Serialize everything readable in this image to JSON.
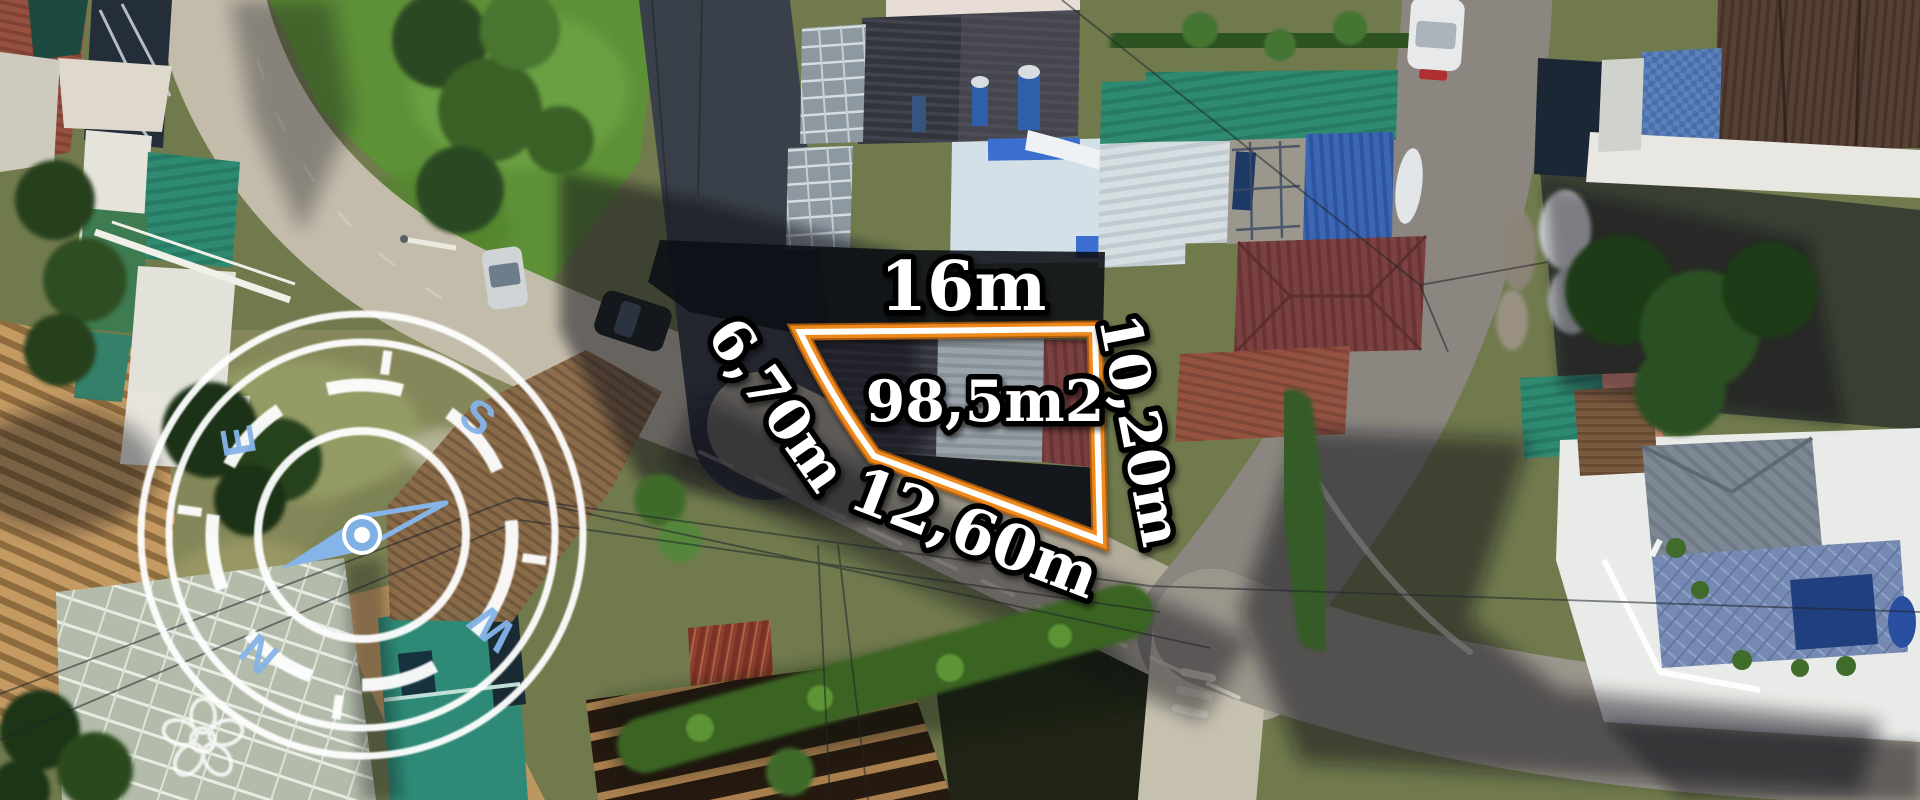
{
  "annotations": {
    "width_top": "16m",
    "area": "98,5m2",
    "side_left": "6,70m",
    "side_right": "10,20m",
    "side_bottom": "12,60m"
  },
  "compass": {
    "letter_n": "N",
    "letter_s": "S",
    "letter_e": "E",
    "letter_w": "W"
  },
  "colors": {
    "plot_outline_orange": "#f0891c",
    "plot_outline_core": "#ffffff",
    "label_text": "#ffffff",
    "label_outline": "#000000",
    "compass_blue": "#85b4e8",
    "compass_ring": "#ffffff"
  }
}
